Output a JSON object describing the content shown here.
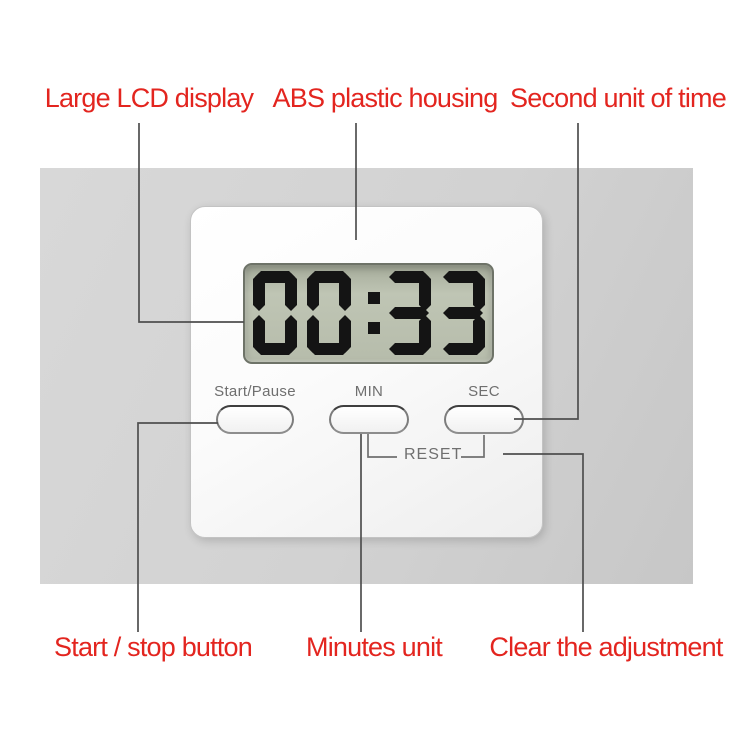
{
  "annotations": {
    "label_color": "#e3251f",
    "line_color": "#4f4f4f",
    "top_labels": [
      "Large LCD display",
      "ABS plastic housing",
      "Second unit of time"
    ],
    "bottom_labels": [
      "Start / stop button",
      "Minutes unit",
      "Clear the adjustment"
    ]
  },
  "timer": {
    "display_time": "00:33",
    "button_labels": [
      "Start/Pause",
      "MIN",
      "SEC"
    ],
    "reset_label": "RESET",
    "lcd_color": "#b6bcab",
    "digit_color": "#141414",
    "body_color": "#fafafa",
    "backdrop_color": "#d2d2d2"
  }
}
